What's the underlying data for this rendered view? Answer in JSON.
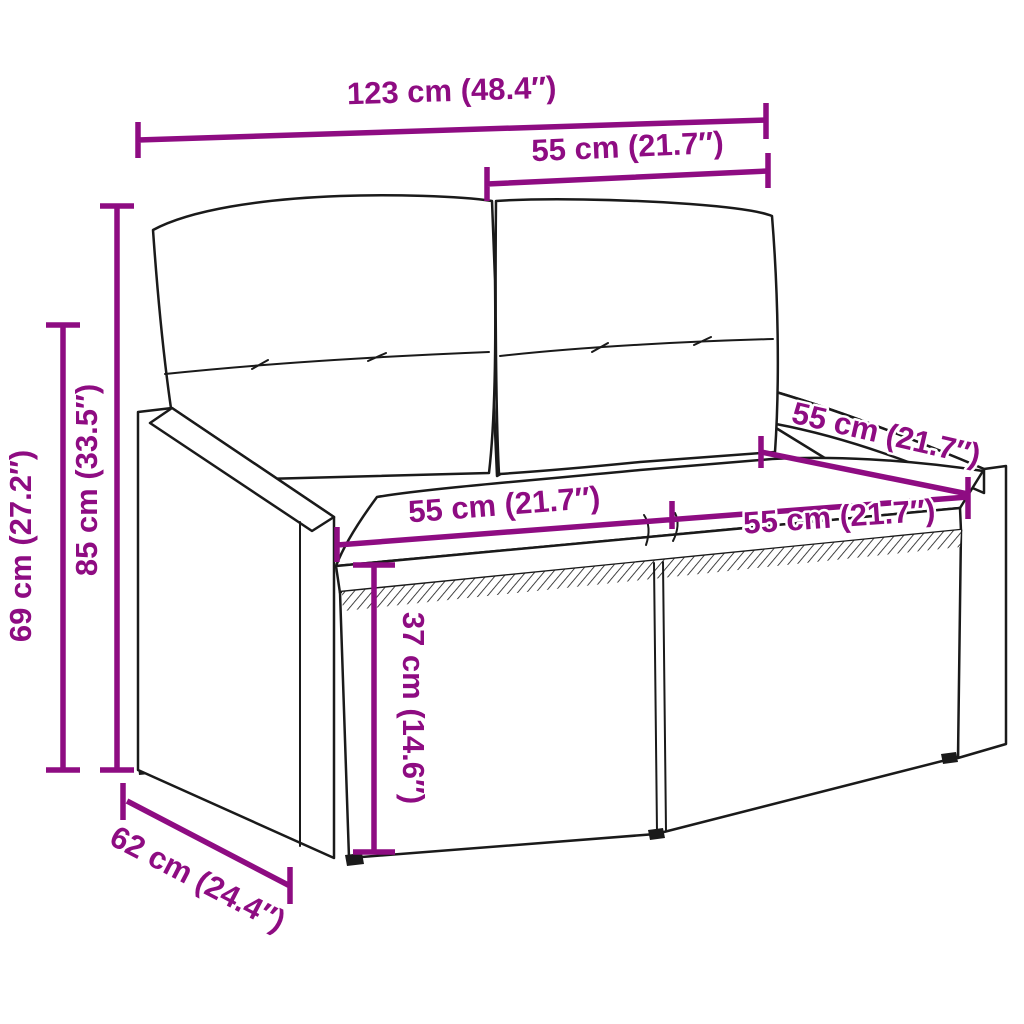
{
  "diagram": {
    "subject": "2-seater poly rattan garden sofa with back and seat cushions",
    "accent_color": "#8E0C82",
    "outline_color": "#1A1A1A",
    "background_color": "#FFFFFF",
    "dimensions": {
      "overall_width": "123 cm (48.4″)",
      "backrest_width": "55 cm (21.7″)",
      "overall_height": "85 cm (33.5″)",
      "armrest_height": "69 cm (27.2″)",
      "left_seat_width": "55 cm (21.7″)",
      "right_seat_width": "55 cm (21.7″)",
      "seat_depth": "55 cm (21.7″)",
      "seat_height": "37 cm (14.6″)",
      "overall_depth": "62 cm (24.4″)"
    }
  }
}
